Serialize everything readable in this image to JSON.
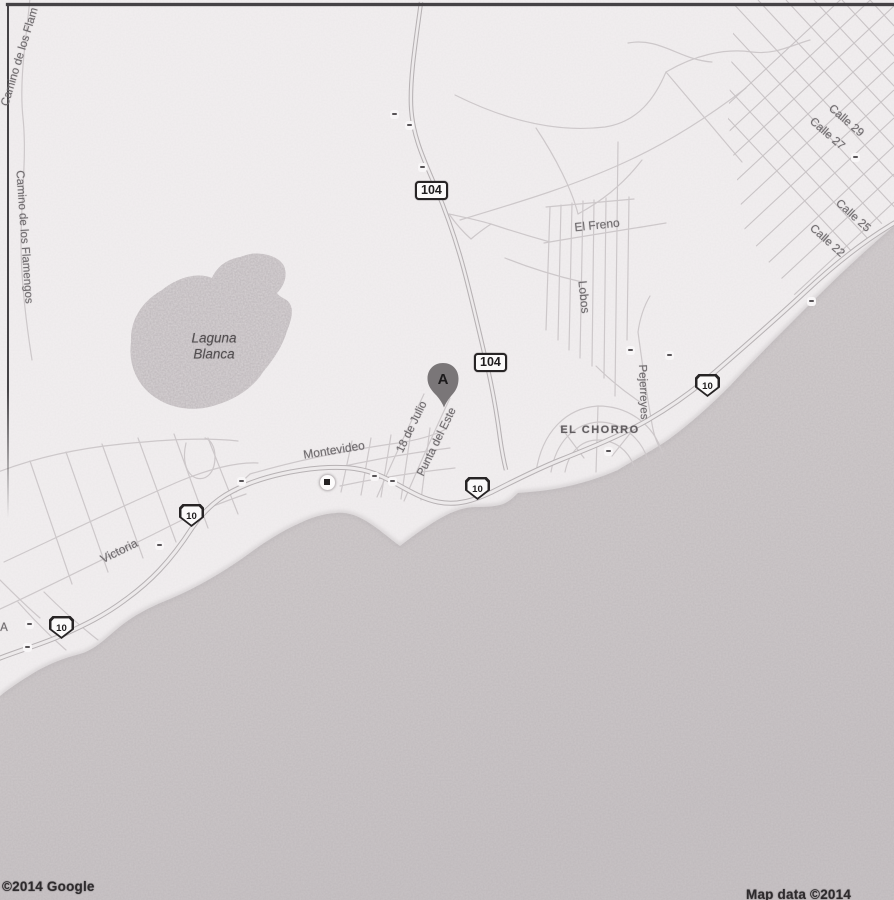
{
  "map": {
    "marker": {
      "label": "A"
    },
    "shields": {
      "route_104": "104",
      "route_10": "10"
    },
    "labels": {
      "camino_flam_top": "Camino de los Flam",
      "camino_flamengos": "Camino de los Flamengos",
      "laguna_line1": "Laguna",
      "laguna_line2": "Blanca",
      "el_freno": "El Freno",
      "lobos": "Lobos",
      "pejerreyes": "Pejerreyes",
      "el_chorro": "EL CHORRO",
      "montevideo": "Montevideo",
      "dieciocho_de_julio": "18 de Julio",
      "punta_del_este": "Punta del Este",
      "victoria": "Victoria",
      "calle_29": "Calle 29",
      "calle_27": "Calle 27",
      "calle_25": "Calle 25",
      "calle_22": "Calle 22",
      "edge_fragment": "A"
    },
    "attribution": {
      "left": "©2014 Google",
      "right": "Map data ©2014 Google"
    },
    "colors": {
      "land": "#f2eff0",
      "sea": "#d3cecf",
      "lake": "#d8d3d5",
      "road_casing": "#b7b2b4",
      "road_fill": "#edeaeb",
      "minor_road": "#cdc8ca",
      "label_text": "#6f6b6e",
      "attribution_text": "#2e2b2d",
      "marker_fill": "#7a7678"
    }
  }
}
